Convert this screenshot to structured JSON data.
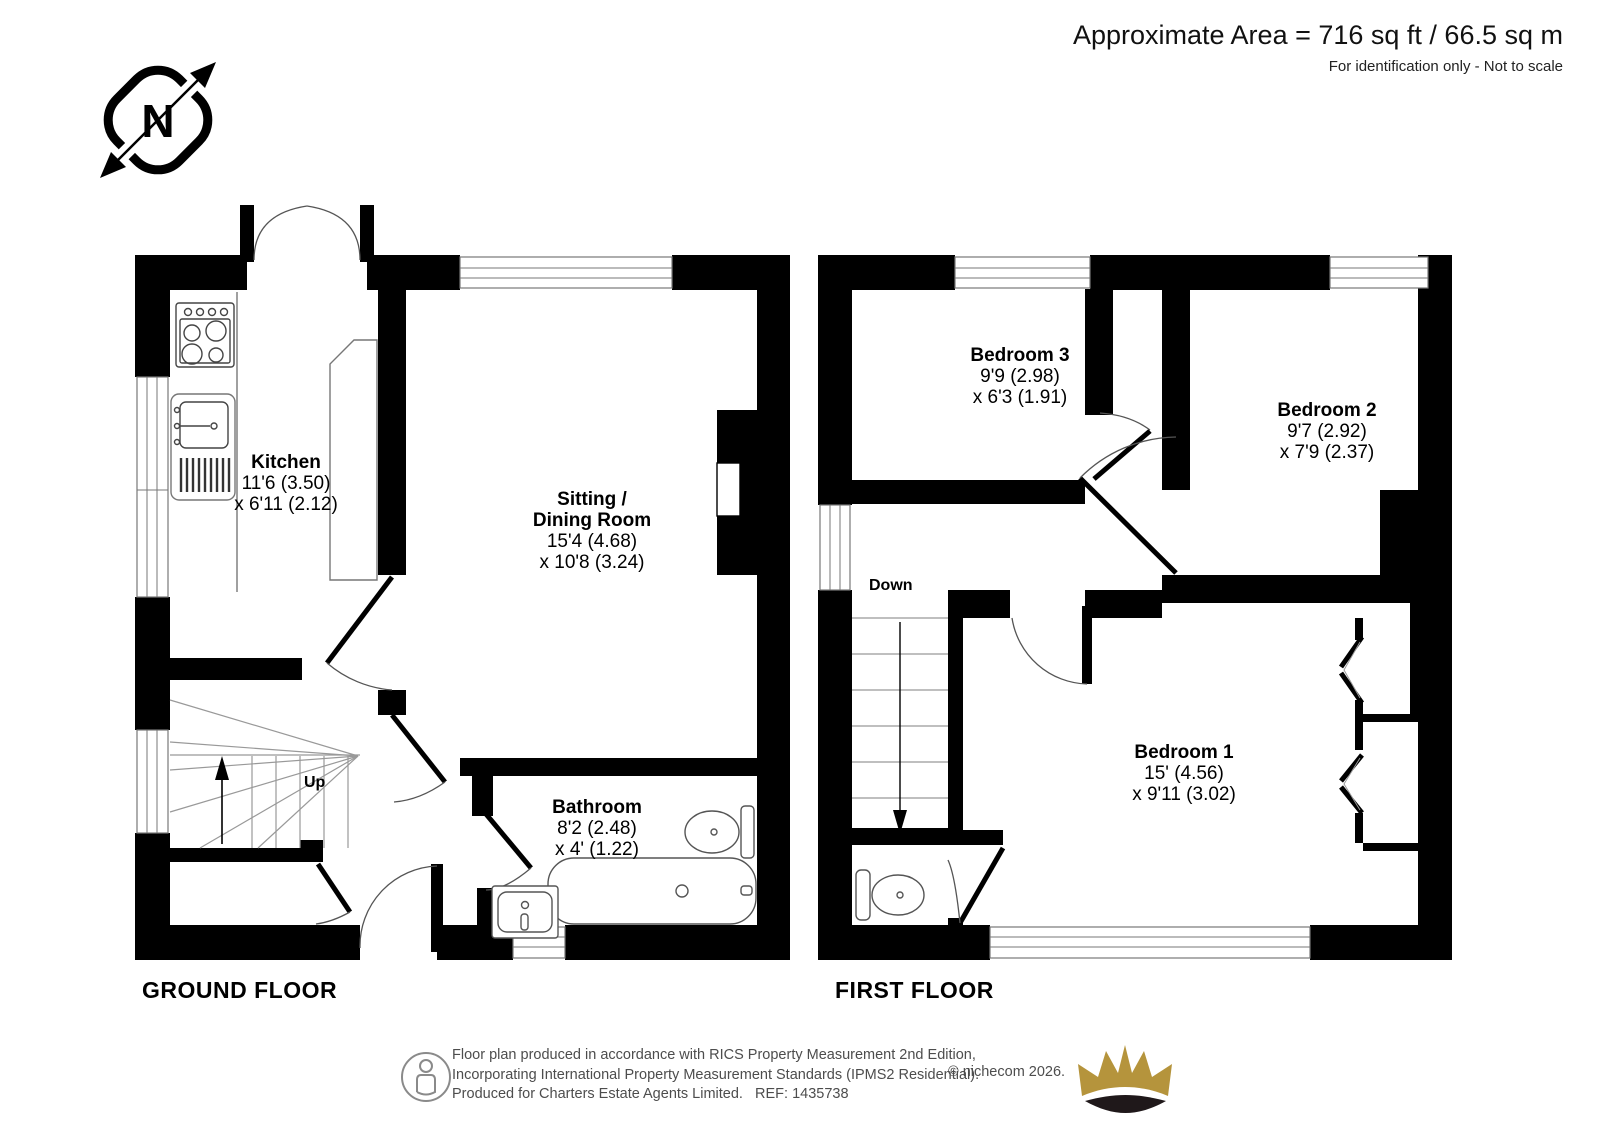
{
  "header": {
    "area_text": "Approximate Area = 716 sq ft / 66.5 sq m",
    "note": "For identification only - Not to scale"
  },
  "compass": {
    "label": "N"
  },
  "ground_floor": {
    "title": "GROUND FLOOR",
    "stairs_label": "Up",
    "kitchen": {
      "name": "Kitchen",
      "dim1": "11'6 (3.50)",
      "dim2": "x 6'11 (2.12)"
    },
    "sitting": {
      "name1": "Sitting /",
      "name2": "Dining Room",
      "dim1": "15'4 (4.68)",
      "dim2": "x 10'8 (3.24)"
    },
    "bathroom": {
      "name": "Bathroom",
      "dim1": "8'2 (2.48)",
      "dim2": "x 4' (1.22)"
    }
  },
  "first_floor": {
    "title": "FIRST FLOOR",
    "stairs_label": "Down",
    "bedroom1": {
      "name": "Bedroom 1",
      "dim1": "15' (4.56)",
      "dim2": "x 9'11 (3.02)"
    },
    "bedroom2": {
      "name": "Bedroom 2",
      "dim1": "9'7 (2.92)",
      "dim2": "x 7'9 (2.37)"
    },
    "bedroom3": {
      "name": "Bedroom 3",
      "dim1": "9'9 (2.98)",
      "dim2": "x 6'3 (1.91)"
    }
  },
  "footer": {
    "line1": "Floor plan produced in accordance with RICS Property Measurement 2nd Edition,",
    "line2": "Incorporating International Property Measurement Standards (IPMS2 Residential).",
    "line3": "Produced for Charters Estate Agents Limited.   REF: 1435738",
    "copyright": "© nichecom 2026."
  },
  "colors": {
    "wall": "#000000",
    "crown_gold": "#b5943c",
    "crown_dark": "#1f181a",
    "muted_text": "#4d4d4d"
  }
}
